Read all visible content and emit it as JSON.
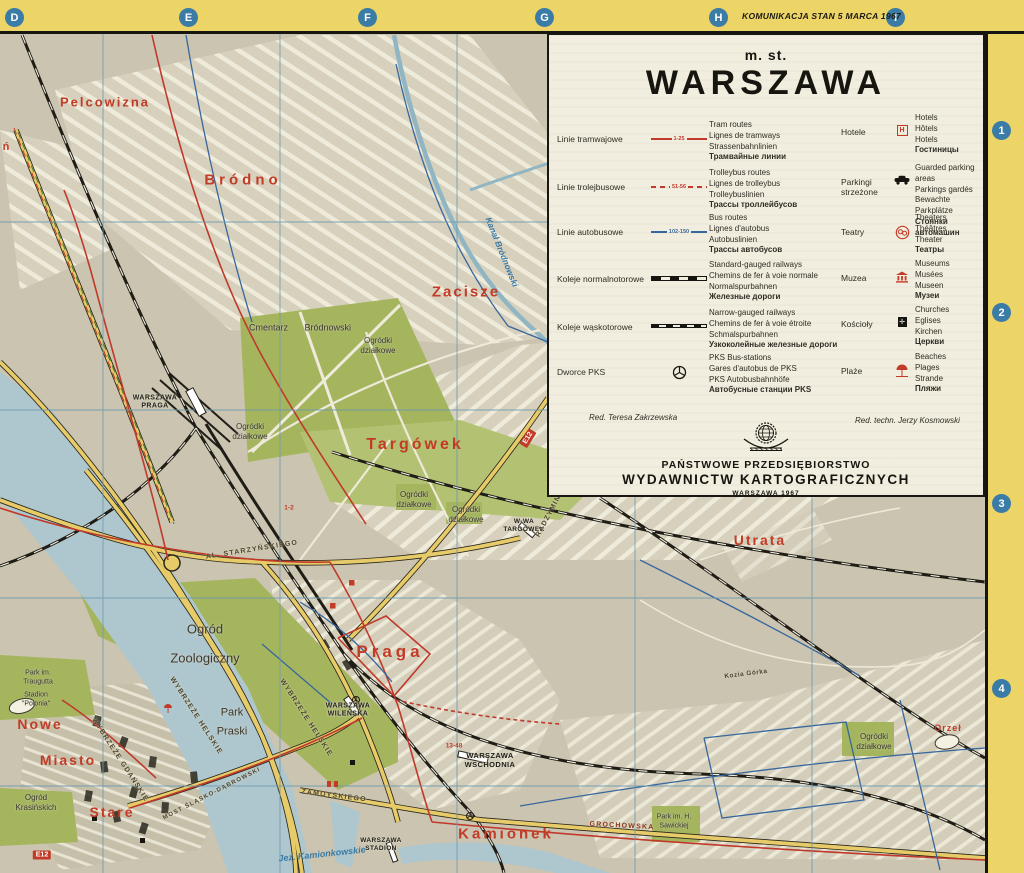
{
  "colors": {
    "border_yellow": "#ecd466",
    "frame_black": "#17150f",
    "map_background": "#cac4b0",
    "legend_background": "#f2eedf",
    "water_blue": "#aec7cf",
    "park_green": "#a4b55e",
    "road_yellow": "#e7cb68",
    "tram_red": "#c0392b",
    "bus_blue": "#38679e",
    "grid_blue": "#6e9ab0",
    "marker_blue": "#3b7ca7",
    "district_red": "#c23b27"
  },
  "frame": {
    "edition_note": "KOMUNIKACJA STAN 5 MARCA 1967",
    "top_letters": [
      "D",
      "E",
      "F",
      "G",
      "H",
      "I"
    ],
    "right_numbers": [
      "1",
      "2",
      "3",
      "4"
    ]
  },
  "legend": {
    "title_prefix": "m. st.",
    "title": "WARSZAWA",
    "left_rows": [
      {
        "label": "Linie tramwajowe",
        "route_numbers": "1-25",
        "translations": [
          "Tram routes",
          "Lignes de tramways",
          "Strassenbahnlinien",
          "Трамвайные линии"
        ]
      },
      {
        "label": "Linie trolejbusowe",
        "route_numbers": "51-56",
        "translations": [
          "Trolleybus routes",
          "Lignes de trolleybus",
          "Trolleybuslinien",
          "Трассы троллейбусов"
        ]
      },
      {
        "label": "Linie autobusowe",
        "route_numbers": "102-150",
        "translations": [
          "Bus routes",
          "Lignes d'autobus",
          "Autobuslinien",
          "Трассы автобусов"
        ]
      },
      {
        "label": "Koleje normalnotorowe",
        "route_numbers": "",
        "translations": [
          "Standard-gauged railways",
          "Chemins de fer à voie normale",
          "Normalspurbahnen",
          "Железные дороги"
        ]
      },
      {
        "label": "Koleje wąskotorowe",
        "route_numbers": "",
        "translations": [
          "Narrow-gauged railways",
          "Chemins de fer à voie étroite",
          "Schmalspurbahnen",
          "Узкоколейные железные дороги"
        ]
      },
      {
        "label": "Dworce PKS",
        "route_numbers": "",
        "translations": [
          "PKS Bus-stations",
          "Gares d'autobus de PKS",
          "PKS Autobusbahnhöfe",
          "Автобусные станции PKS"
        ]
      }
    ],
    "right_rows": [
      {
        "label": "Hotele",
        "translations": [
          "Hotels",
          "Hôtels",
          "Hotels",
          "Гостиницы"
        ]
      },
      {
        "label": "Parkingi strzeżone",
        "translations": [
          "Guarded parking areas",
          "Parkings gardés",
          "Bewachte Parkplätze",
          "Стоянки автомашин"
        ]
      },
      {
        "label": "Teatry",
        "translations": [
          "Theaters",
          "Théâtres",
          "Theater",
          "Театры"
        ]
      },
      {
        "label": "Muzea",
        "translations": [
          "Museums",
          "Musées",
          "Museen",
          "Музеи"
        ]
      },
      {
        "label": "Kościoły",
        "translations": [
          "Churches",
          "Eglises",
          "Kirchen",
          "Церкви"
        ]
      },
      {
        "label": "Plaże",
        "translations": [
          "Beaches",
          "Plages",
          "Strande",
          "Пляжи"
        ]
      }
    ],
    "hotel_icon_letter": "H",
    "credits": {
      "editor": "Red. Teresa Zakrzewska",
      "technical_editor": "Red. techn. Jerzy Kosmowski"
    },
    "publisher": {
      "line1": "PAŃSTWOWE PRZEDSIĘBIORSTWO",
      "line2": "WYDAWNICTW KARTOGRAFICZNYCH",
      "line3": "WARSZAWA 1967"
    }
  },
  "map": {
    "districts": [
      {
        "name": "Pelcowizna"
      },
      {
        "name": "Bródno"
      },
      {
        "name": "Zacisze"
      },
      {
        "name": "Targówek"
      },
      {
        "name": "Praga"
      },
      {
        "name": "Nowe"
      },
      {
        "name": "Miasto"
      },
      {
        "name": "Stare"
      },
      {
        "name": "Kamionek"
      },
      {
        "name": "Utrata"
      },
      {
        "name": "Orzeł"
      }
    ],
    "stations": [
      {
        "name": "WARSZAWA PRAGA"
      },
      {
        "name": "W-WA TARGÓWEK"
      },
      {
        "name": "WARSZAWA WILEŃSKA"
      },
      {
        "name": "WARSZAWA WSCHODNIA"
      },
      {
        "name": "WARSZAWA STADION"
      }
    ],
    "places": [
      {
        "name": "Cmentarz  Bródnowski"
      },
      {
        "name": "Ogródki działkowe"
      },
      {
        "name": "Ogródki działkowe"
      },
      {
        "name": "Ogródki działkowe"
      },
      {
        "name": "Ogródki działkowe"
      },
      {
        "name": "Ogródki działkowe"
      },
      {
        "name": "Ogród Zoologiczny"
      },
      {
        "name": "Park Praski"
      },
      {
        "name": "Park im. Traugutta"
      },
      {
        "name": "Stadion \"Polonia\""
      },
      {
        "name": "Ogród Krasińskich"
      },
      {
        "name": "Park im. H. Sawickiej"
      }
    ],
    "roads": [
      {
        "name": "WYBRZEŻE HELSKIE"
      },
      {
        "name": "WYBRZEŻE HELSKIE"
      },
      {
        "name": "WYBRZEŻE GDAŃSKIE"
      },
      {
        "name": "AL. STARZYŃSKIEGO"
      },
      {
        "name": "RADZYMIŃSKA"
      },
      {
        "name": "ZAMOYSKIEGO"
      },
      {
        "name": "GROCHOWSKA"
      },
      {
        "name": "MOST ŚLĄSKO-DĄBROWSKI"
      },
      {
        "name": "Kozia Górka"
      }
    ],
    "waters": [
      {
        "name": "Jez. Kamionkowskie"
      },
      {
        "name": "Kanał Bródnowski"
      }
    ],
    "route_markers": [
      {
        "text": "E12"
      },
      {
        "text": "E12"
      },
      {
        "text": "13-48"
      },
      {
        "text": "1-2"
      }
    ],
    "edge_labels": [
      {
        "text": "ń"
      }
    ]
  }
}
